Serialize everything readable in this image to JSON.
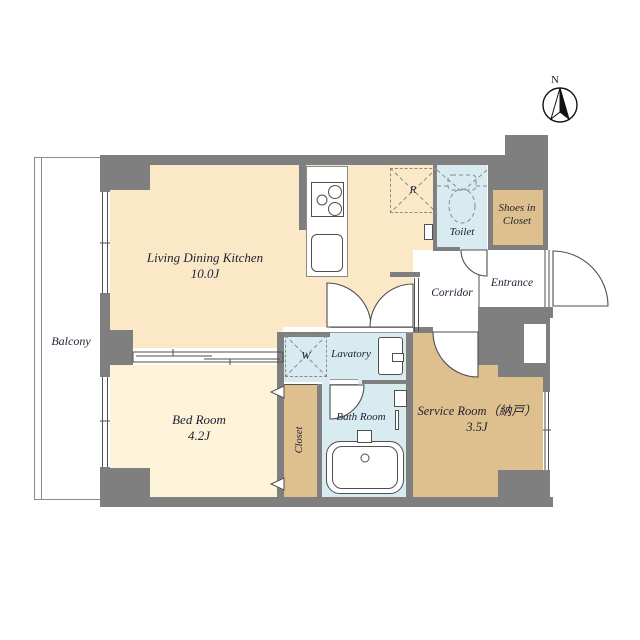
{
  "colors": {
    "wall": "#7f7f7f",
    "ldk": "#fbe8c7",
    "bedroom": "#fcf3d9",
    "storage_tan": "#dec08e",
    "wet_blue": "#d7ebf1",
    "outline": "#4f4f4f",
    "text": "#1f1f33"
  },
  "compass": {
    "north_label": "N"
  },
  "rooms": {
    "balcony": {
      "label": "Balcony"
    },
    "ldk": {
      "label": "Living Dining Kitchen",
      "area": "10.0J"
    },
    "bedroom": {
      "label": "Bed Room",
      "area": "4.2J"
    },
    "service_room": {
      "label": "Service Room（納戸）",
      "area": "3.5J"
    },
    "bath": {
      "label": "Bath Room"
    },
    "lavatory": {
      "label": "Lavatory"
    },
    "toilet": {
      "label": "Toilet"
    },
    "corridor": {
      "label": "Corridor"
    },
    "entrance": {
      "label": "Entrance"
    },
    "shoes_closet": {
      "label_line1": "Shoes in",
      "label_line2": "Closet"
    },
    "closet": {
      "label": "Closet"
    }
  },
  "markers": {
    "refrigerator": "R",
    "washer": "W"
  }
}
